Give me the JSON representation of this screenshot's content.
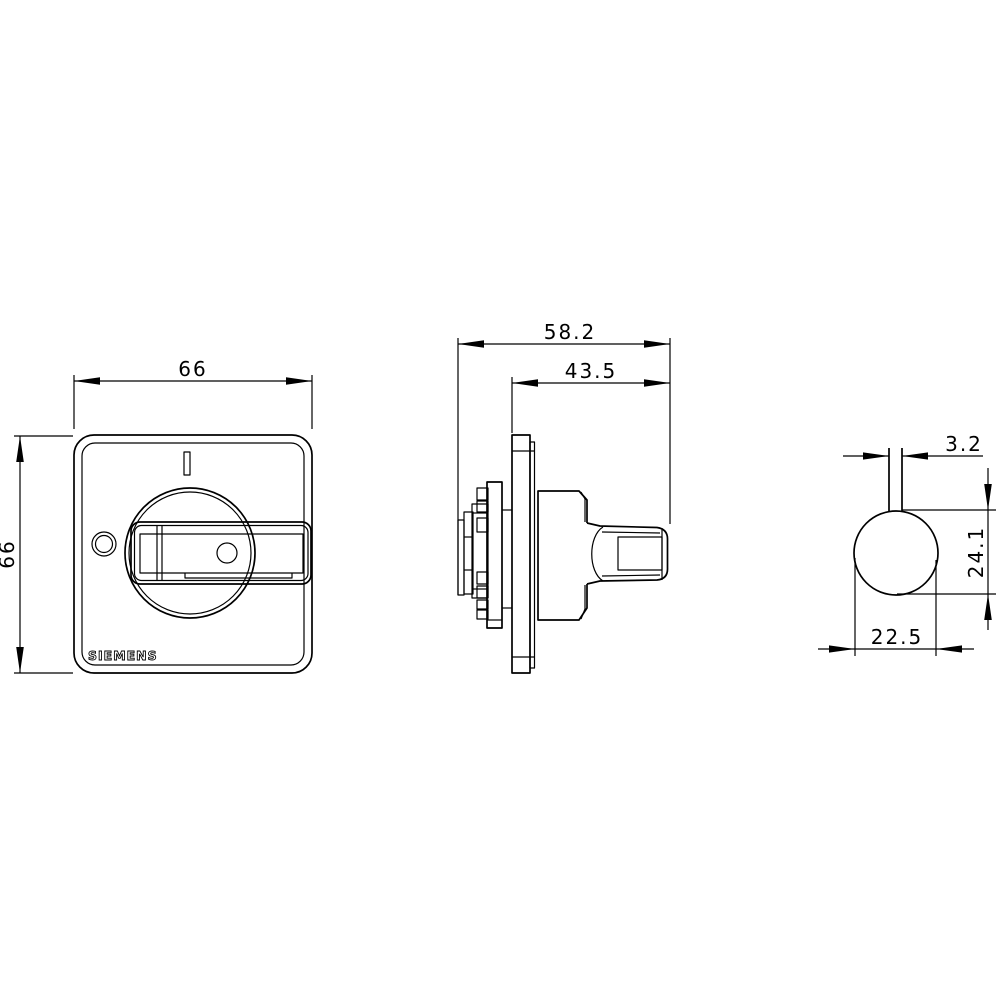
{
  "page": {
    "background": "#ffffff",
    "line_color": "#000000"
  },
  "brand_label": "SIEMENS",
  "views": {
    "front": {
      "label_width": "66",
      "label_height": "66"
    },
    "side": {
      "label_total_depth": "58.2",
      "label_front_depth": "43.5"
    },
    "end": {
      "label_handle_width": "3.2",
      "label_height": "24.1",
      "label_width": "22.5"
    }
  }
}
